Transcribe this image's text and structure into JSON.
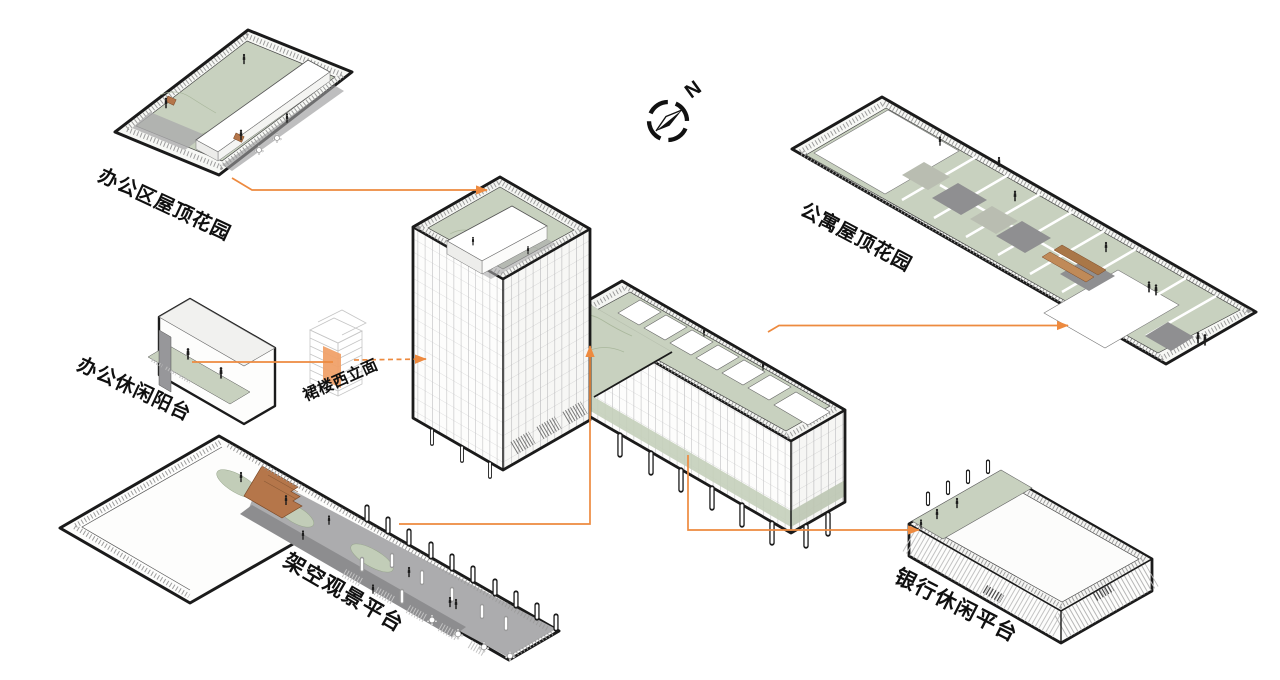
{
  "compass": {
    "label": "N"
  },
  "annotations": [
    {
      "id": "office-roof-garden",
      "label": "办公区屋顶花园"
    },
    {
      "id": "apartment-roof-garden",
      "label": "公寓屋顶花园"
    },
    {
      "id": "office-balcony",
      "label": "办公休闲阳台"
    },
    {
      "id": "podium-west-facade",
      "label": "裙楼西立面"
    },
    {
      "id": "elevated-viewing-platform",
      "label": "架空观景平台"
    },
    {
      "id": "bank-leisure-platform",
      "label": "银行休闲平台"
    }
  ],
  "colors": {
    "leader": "#ED8A3F",
    "facade_highlight": "#F0A169",
    "garden_green": "#C8D1BF",
    "deck_gray": "#ACACAE",
    "path_gray": "#8D8D8F",
    "wood_brown": "#B5764A",
    "outline": "#1B1B1B"
  }
}
